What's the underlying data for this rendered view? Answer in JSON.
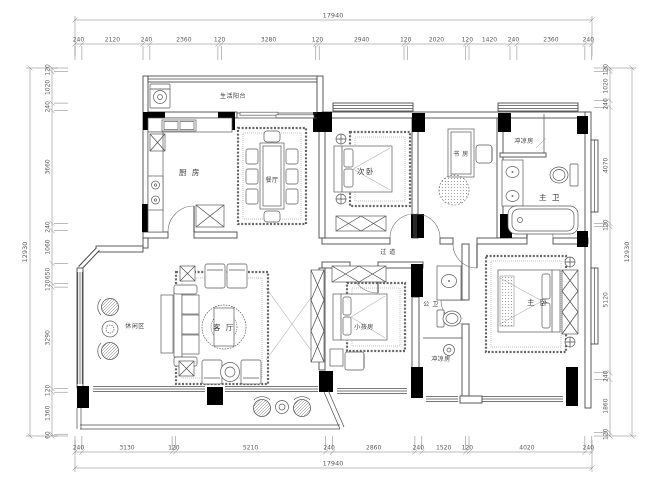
{
  "plan": {
    "rooms": {
      "service_balcony": "生活阳台",
      "kitchen": "厨 房",
      "dining": "餐厅",
      "second_bedroom": "次卧",
      "study": "书 房",
      "shower_room_top": "冲凉房",
      "master_bath": "主 卫",
      "corridor": "过 道",
      "leisure_area": "休闲区",
      "living_room": "客 厅",
      "kids_room": "小孩房",
      "guest_bath": "公 卫",
      "shower_room_bottom": "冲凉房",
      "master_bedroom": "主 卧"
    }
  },
  "dims": {
    "top_total": "17940",
    "top": [
      "240",
      "2120",
      "240",
      "2360",
      "120",
      "3280",
      "120",
      "2940",
      "120",
      "2020",
      "120",
      "1420",
      "240",
      "2360",
      "240"
    ],
    "bottom": [
      "240",
      "3130",
      "120",
      "5210",
      "240",
      "2860",
      "240",
      "1520",
      "120",
      "4020",
      "240"
    ],
    "bottom_total": "17940",
    "left": [
      "120",
      "1020",
      "240",
      "3660",
      "240",
      "1060",
      "650",
      "120",
      "3290",
      "120",
      "1360",
      "60"
    ],
    "left_total": "12930",
    "right": [
      "120",
      "1020",
      "240",
      "4070",
      "120",
      "5120",
      "240",
      "1860",
      "120"
    ],
    "right_total": "12930"
  },
  "colors": {
    "line": "#4a4a4a",
    "dimension": "#7a7a7a",
    "column_fill": "#000000",
    "background": "#ffffff"
  }
}
